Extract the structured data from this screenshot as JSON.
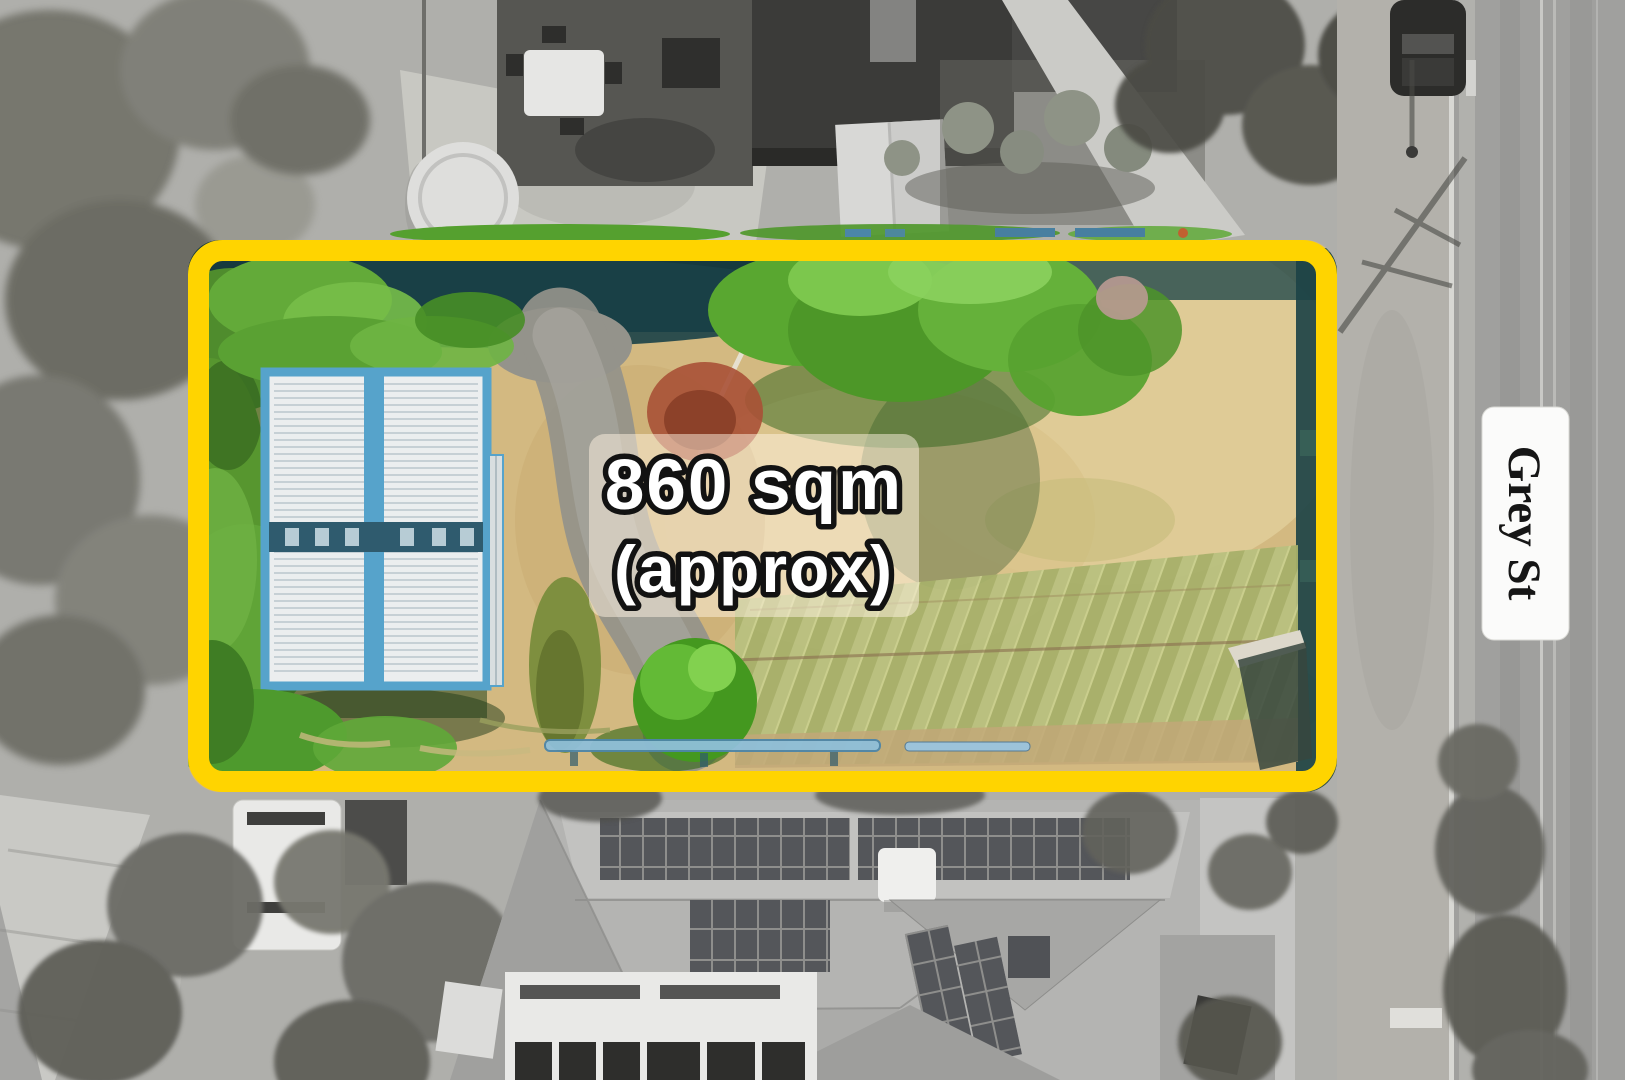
{
  "annotations": {
    "area_overlay": {
      "line1": "860 sqm",
      "line2": "(approx)"
    },
    "street_sign": {
      "label": "Grey St"
    }
  },
  "colors": {
    "boundary_yellow": "#FFD400",
    "overlay_text_fill": "#FFFFFF",
    "overlay_text_outline": "#121212",
    "overlay_panel_bg": "#FFF4E2",
    "street_sign_bg": "#FBFBFA",
    "street_sign_text": "#161616",
    "building_trim_blue": "#56A3CB",
    "dry_grass_tan": "#D3B981",
    "vegetation_green": "#58A432",
    "fence_shadow_teal": "#1A4147"
  }
}
